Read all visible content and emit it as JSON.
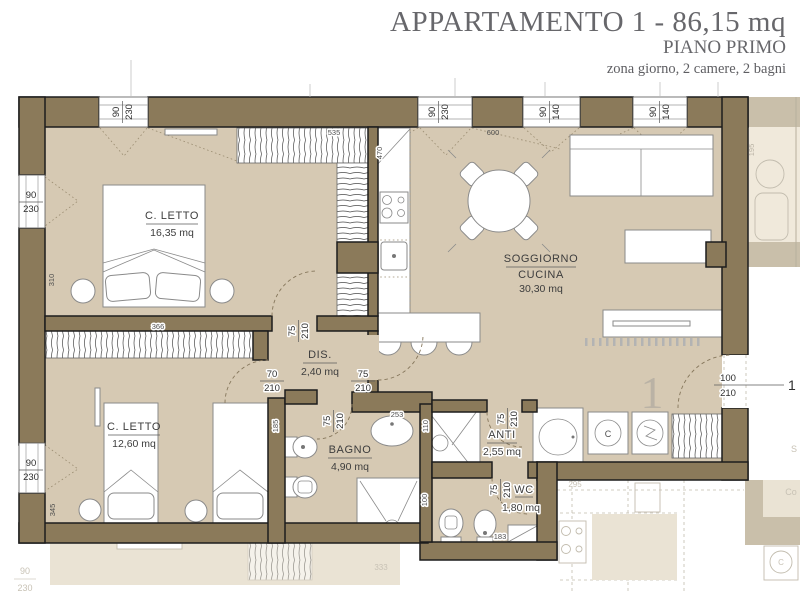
{
  "title": {
    "main": "APPARTAMENTO 1 - 86,15 mq",
    "floor": "PIANO PRIMO",
    "subtitle": "zona giorno, 2 camere, 2 bagni"
  },
  "rooms": {
    "bedroom1": {
      "name": "C. LETTO",
      "area": "16,35 mq"
    },
    "bedroom2": {
      "name": "C. LETTO",
      "area": "12,60 mq"
    },
    "hallway": {
      "name": "DIS.",
      "area": "2,40 mq"
    },
    "bathroom": {
      "name": "BAGNO",
      "area": "4,90 mq"
    },
    "living": {
      "name_line1": "SOGGIORNO",
      "name_line2": "CUCINA",
      "area": "30,30 mq"
    },
    "anteroom": {
      "name": "ANTI",
      "area": "2,55 mq"
    },
    "wc": {
      "name": "WC",
      "area": "1,80 mq"
    }
  },
  "openings": {
    "win_top1": {
      "w": "90",
      "h": "230"
    },
    "win_top2": {
      "w": "90",
      "h": "230"
    },
    "win_top3": {
      "w": "90",
      "h": "140"
    },
    "win_top4": {
      "w": "90",
      "h": "140"
    },
    "win_left1": {
      "w": "90",
      "h": "230"
    },
    "win_left2": {
      "w": "90",
      "h": "230"
    },
    "door_bedroom1": {
      "w": "75",
      "h": "210"
    },
    "door_bedroom2": {
      "w": "70",
      "h": "210"
    },
    "door_living": {
      "w": "75",
      "h": "210"
    },
    "door_bathroom": {
      "w": "75",
      "h": "210"
    },
    "door_anteroom": {
      "w": "75",
      "h": "210"
    },
    "door_wc": {
      "w": "75",
      "h": "210"
    },
    "door_entry": {
      "w": "100",
      "h": "210"
    }
  },
  "measures": {
    "wardrobe_top": "535",
    "kitchen_run": "470",
    "living_wall": "600",
    "bedroom1_wall": "310",
    "wardrobe_bedroom2": "366",
    "bedroom2_wall": "345",
    "bathroom_wall": "185",
    "basin": "253",
    "anti_shower": "110",
    "wc_wall": "100",
    "wc_shelf": "183",
    "balcony": "195"
  },
  "markers": {
    "unit_number": "1",
    "entry_ref": "1",
    "washer_letter": "C"
  },
  "ghost": {
    "dim_a": "295",
    "dim_b": "333",
    "win_w": "90",
    "win_h": "230",
    "label_a": "S",
    "label_b": "Co",
    "washer_letter": "C"
  },
  "colors": {
    "wall": "#8b7a5a",
    "floor": "#d6c9b3",
    "ghost_floor": "#eae3d4",
    "ghost_wall": "#c9bfaa",
    "label": "#3d3d3d",
    "title": "#67676b"
  }
}
